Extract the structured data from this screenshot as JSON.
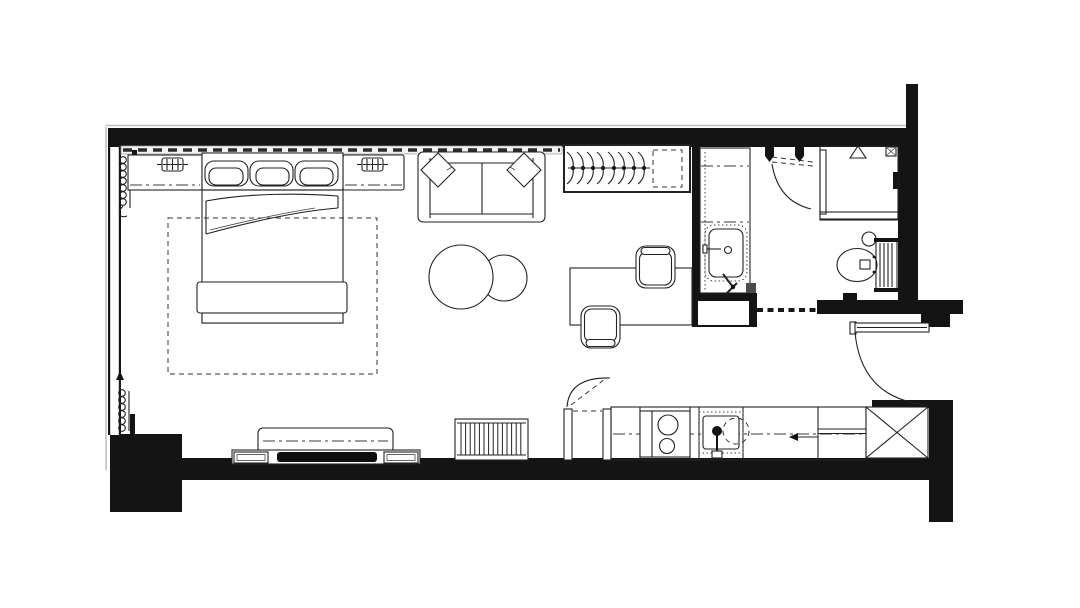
{
  "page": {
    "title": "Studio Apartment Floor Plan",
    "background": "#ffffff"
  },
  "colors": {
    "wall": "#141414",
    "line": "#222222",
    "floor": "#ffffff",
    "tv_screen": "#0d0d0d",
    "outer_edge": "#bdbdbd"
  },
  "rooms": [
    {
      "id": "bedroom",
      "label": "Bedroom area"
    },
    {
      "id": "living",
      "label": "Living area"
    },
    {
      "id": "bathroom",
      "label": "Bathroom"
    },
    {
      "id": "kitchen",
      "label": "Kitchenette"
    },
    {
      "id": "entry",
      "label": "Entry"
    }
  ],
  "furniture": {
    "floor_plan": "Studio apartment floor plan drawing",
    "walls": "Structural walls",
    "window_left": "Floor-to-ceiling window (west)",
    "curtain_track": "Curtain track along north glazing",
    "curtain_top": "Curtain coil (north-west corner)",
    "curtain_bottom": "Curtain coil (south-west corner)",
    "nightstand_left": "Left bedside ledge with table lamp",
    "nightstand_right": "Right bedside ledge with table lamp",
    "lamp_left": "Table lamp",
    "lamp_right": "Table lamp",
    "bed": "Double bed with three pillows and folded duvet",
    "bed_foot_bench": "Bed-end bench",
    "rug": "Area rug (dashed outline)",
    "sofa": "Two-seat sofa with throw pillows",
    "coffee_tables": "Round nesting coffee tables",
    "desk": "Work desk",
    "desk_chair_top": "Desk chair",
    "desk_chair_bottom": "Desk chair",
    "wardrobe": "Open wardrobe with eight hangers",
    "wardrobe_shelf": "Wardrobe shelf (dashed)",
    "tv_bench": "Media bench",
    "tv_console": "TV console with flat-screen TV",
    "radiator_living": "Radiator",
    "kitchen_door": "Kitchen doorway with swing",
    "kitchen_counter": "Kitchen counter run",
    "stove": "Two-burner cooktop",
    "kitchen_sink": "Kitchen sink with mixer tap",
    "kitchen_arrow": "Direction arrow",
    "kitchen_shelf": "Counter shelf section",
    "appliance_space": "Appliance space (crossed box)",
    "vanity": "Bathroom vanity cabinet with washbasin",
    "bathroom_door": "Bathroom door with swing",
    "shower": "Walk-in shower with glass screen",
    "shower_head": "Shower head",
    "floor_drain": "Floor drain",
    "toilet": "Wall-hung toilet",
    "cistern_button": "Flush plate",
    "towel_radiator": "Towel radiator",
    "bathroom_threshold": "Bathroom threshold (dashed)",
    "entry_door": "Entrance door with swing"
  }
}
